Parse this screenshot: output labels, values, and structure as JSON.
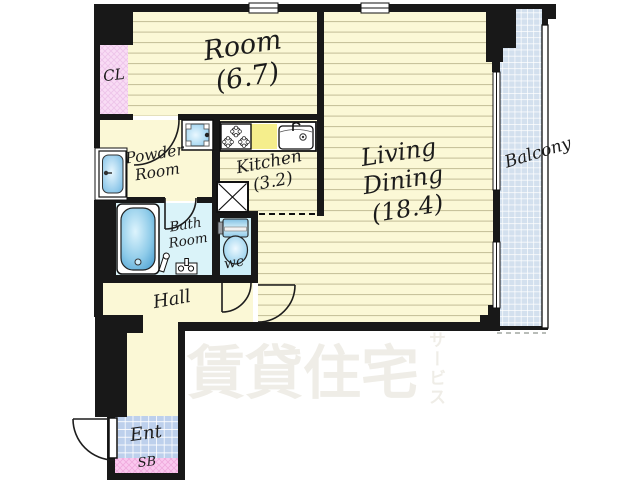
{
  "plan": {
    "labels": {
      "room": {
        "name": "Room",
        "size": "(6.7)"
      },
      "closet": {
        "name": "CL"
      },
      "powder_room": {
        "name_line1": "Powder",
        "name_line2": "Room"
      },
      "kitchen": {
        "name": "Kitchen",
        "size": "(3.2)"
      },
      "living_dining": {
        "name_line1": "Living",
        "name_line2": "Dining",
        "size": "(18.4)"
      },
      "balcony": {
        "name": "Balcony"
      },
      "bath_room": {
        "name_line1": "Bath",
        "name_line2": "Room"
      },
      "wc": {
        "name": "wc"
      },
      "hall": {
        "name": "Hall"
      },
      "entrance": {
        "name": "Ent"
      },
      "shoe_box": {
        "name": "SB"
      }
    },
    "watermark": {
      "main": "賃貸住宅",
      "side": "サービス"
    },
    "palette": {
      "wall": "#181818",
      "floor_yellow": "#fbf8d6",
      "floor_stripe": "#c3bd96",
      "counter_yellow": "#f5ee8c",
      "closet_pink": "#f9dcf5",
      "shoebox_pink": "#fac9ef",
      "bath_cyan": "#daf3f9",
      "wc_cyan": "#cdeef8",
      "balcony_blue": "#d3e0ee",
      "entrance_blue": "#bdd0ec",
      "fixture_blue": "#5fb0e0",
      "watermark_grey": "#efede7"
    },
    "icons": [
      "bathtub-icon",
      "toilet-icon",
      "washbasin-icon",
      "washer-pan-icon",
      "gas-stove-icon",
      "kitchen-sink-icon",
      "refrigerator-space-icon",
      "door-swing-icon",
      "window-icon"
    ]
  }
}
